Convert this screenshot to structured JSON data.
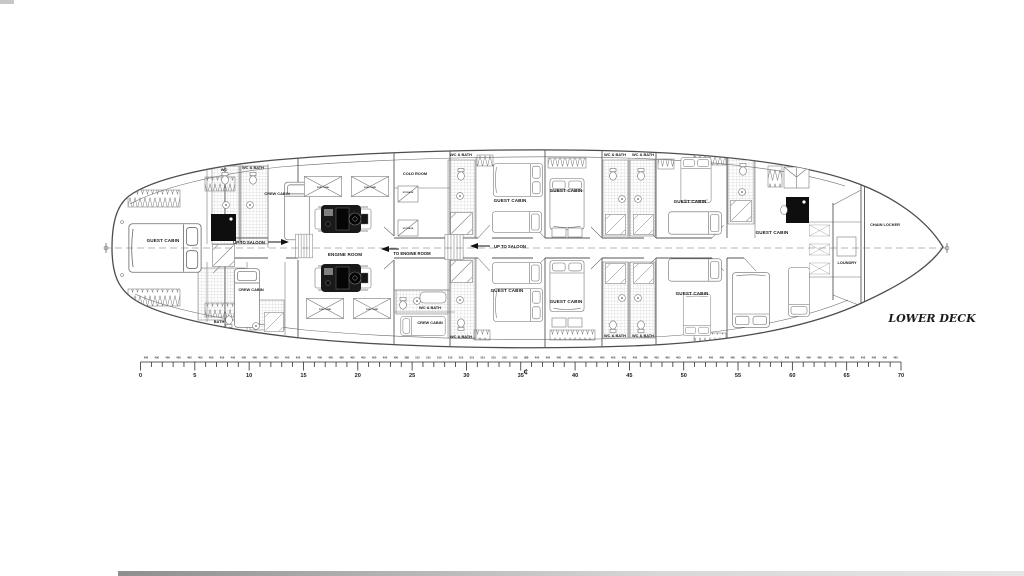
{
  "title": "LOWER DECK",
  "labels": {
    "guest_cabin": "GUEST CABIN",
    "crew_cabin": "CREW CABIN",
    "engine_room": "ENGINE ROOM",
    "wc": "WC",
    "wc_bath": "WC & BATH",
    "bath": "BATH",
    "cold_room": "COLD ROOM",
    "storage": "STORAGE",
    "chain_locker": "CHAIN LOCKER",
    "laundry": "LOUNDRY",
    "fuel_tank": "FUEL TANK"
  },
  "nav": {
    "up_to_saloon": "UP TO SALOON",
    "to_engine_room": "TO ENGINE ROOM"
  },
  "ruler": {
    "frame_count": 70,
    "major_labels": [
      "0",
      "5",
      "10",
      "15",
      "20",
      "25",
      "30",
      "35",
      "40",
      "45",
      "50",
      "55",
      "60",
      "65",
      "70"
    ],
    "spacing_default": "400",
    "spacing_engine": "515",
    "spacing_boundary": "388",
    "engine_start_frame": 26,
    "engine_end_frame": 35,
    "boundary_frames": [
      25,
      36
    ],
    "centerline_symbol": "₵"
  }
}
